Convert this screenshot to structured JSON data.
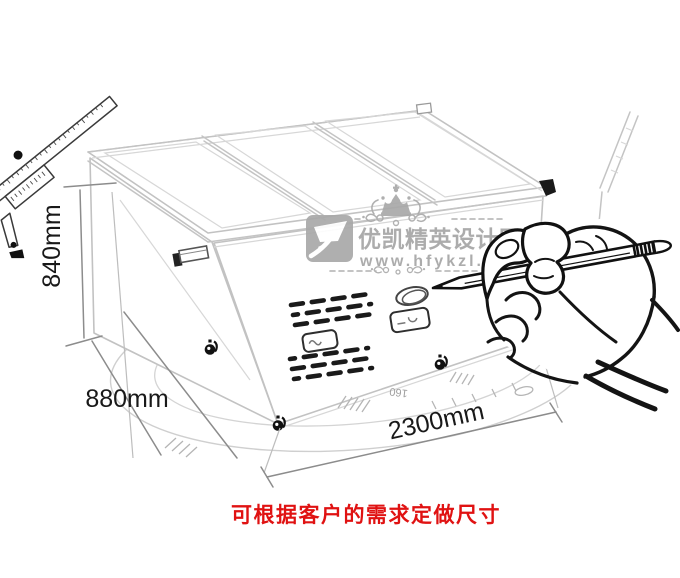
{
  "dimensions": {
    "height": "840mm",
    "depth": "880mm",
    "length": "2300mm"
  },
  "protractor": {
    "label": "160"
  },
  "watermark": {
    "brand": "优凯精英设计团队",
    "website": "www.hfykzl.com",
    "color": "#a6a6a6",
    "crown_icon": "crown-ornament",
    "logo_icon": "yk-brand-badge"
  },
  "caption": {
    "text": "可根据客户的需求定做尺寸",
    "color": "#e01212"
  },
  "illustration": {
    "subject": "island-display-freezer-line-art",
    "icons": [
      "vernier-caliper-icon",
      "hand-holding-pencil-icon",
      "caster-wheel-icon",
      "vent-grille",
      "lid-handle",
      "sliding-glass-lid"
    ],
    "ink_color": "#141414",
    "sketch_color": "#c4c4c4"
  }
}
